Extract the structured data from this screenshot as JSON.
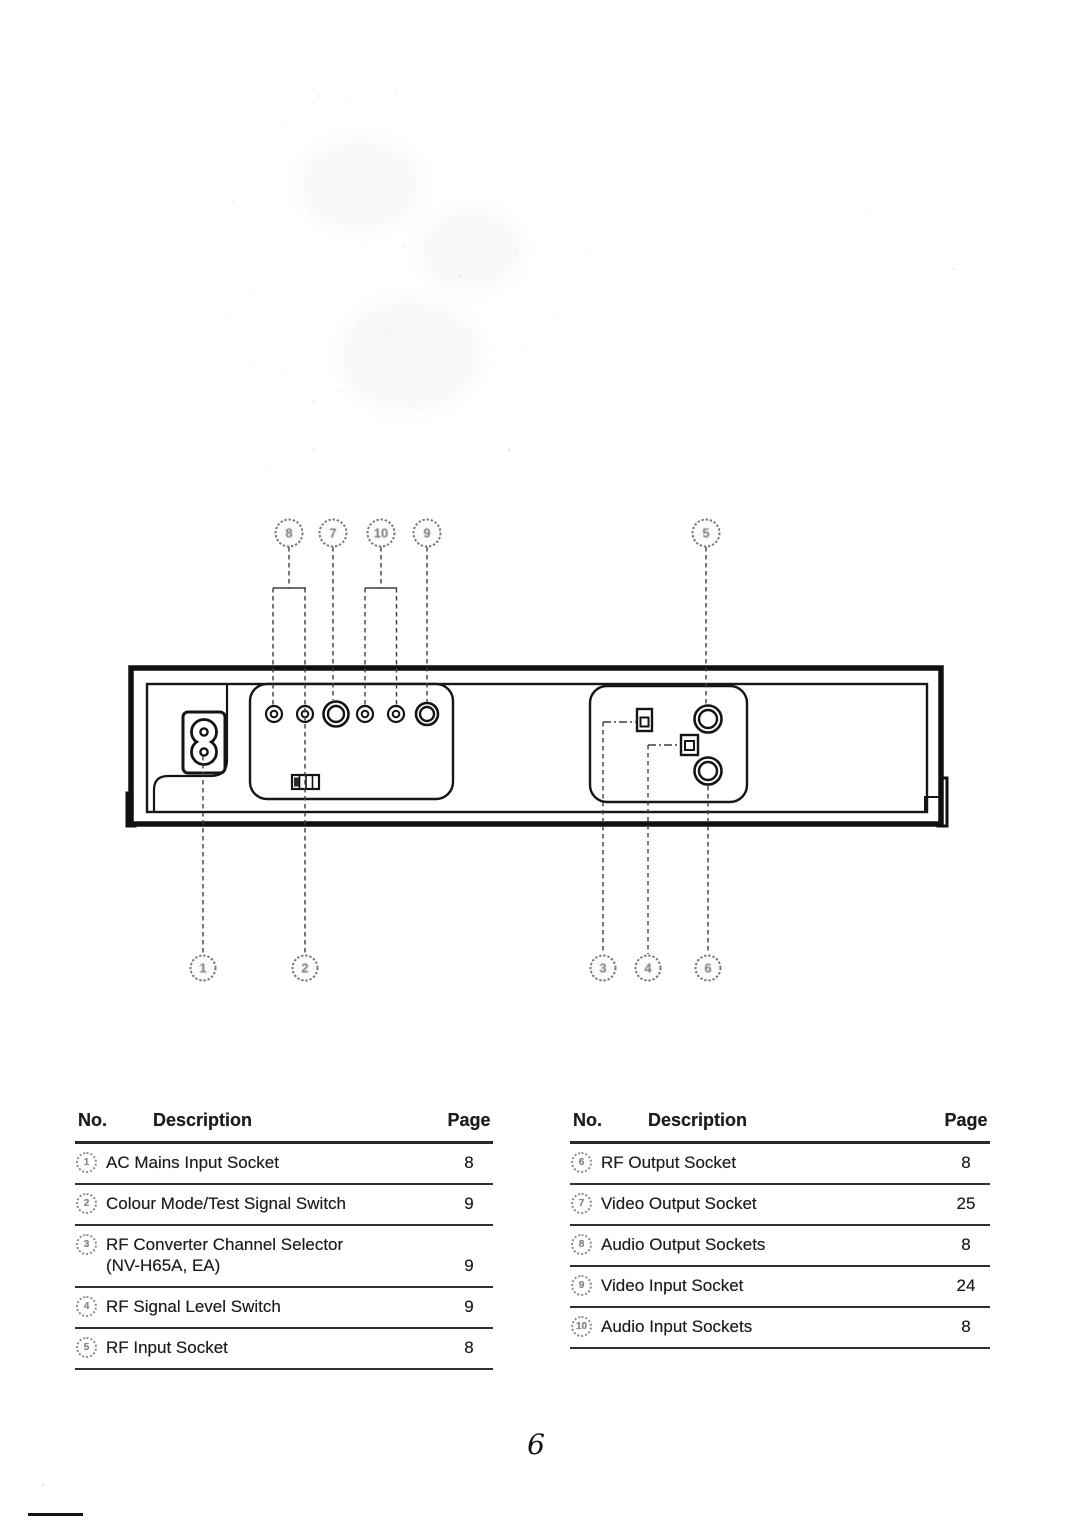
{
  "page": {
    "number": "6"
  },
  "diagram": {
    "callouts": {
      "c1": "1",
      "c2": "2",
      "c3": "3",
      "c4": "4",
      "c5": "5",
      "c6": "6",
      "c7": "7",
      "c8": "8",
      "c9": "9",
      "c10": "10"
    }
  },
  "tables": {
    "left": {
      "headers": {
        "no": "No.",
        "description": "Description",
        "page": "Page"
      },
      "rows": [
        {
          "no": "1",
          "description": "AC Mains Input Socket",
          "page": "8"
        },
        {
          "no": "2",
          "description": "Colour Mode/Test Signal Switch",
          "page": "9"
        },
        {
          "no": "3",
          "description": "RF Converter Channel Selector",
          "description_line2": "(NV-H65A, EA)",
          "page": "9"
        },
        {
          "no": "4",
          "description": "RF Signal Level Switch",
          "page": "9"
        },
        {
          "no": "5",
          "description": "RF Input Socket",
          "page": "8"
        }
      ]
    },
    "right": {
      "headers": {
        "no": "No.",
        "description": "Description",
        "page": "Page"
      },
      "rows": [
        {
          "no": "6",
          "description": "RF Output Socket",
          "page": "8"
        },
        {
          "no": "7",
          "description": "Video Output Socket",
          "page": "25"
        },
        {
          "no": "8",
          "description": "Audio Output Sockets",
          "page": "8"
        },
        {
          "no": "9",
          "description": "Video Input Socket",
          "page": "24"
        },
        {
          "no": "10",
          "description": "Audio Input Sockets",
          "page": "8"
        }
      ]
    }
  },
  "colors": {
    "ink": "#141414",
    "leader_line": "#3f3f3f",
    "badge": "#787878"
  }
}
